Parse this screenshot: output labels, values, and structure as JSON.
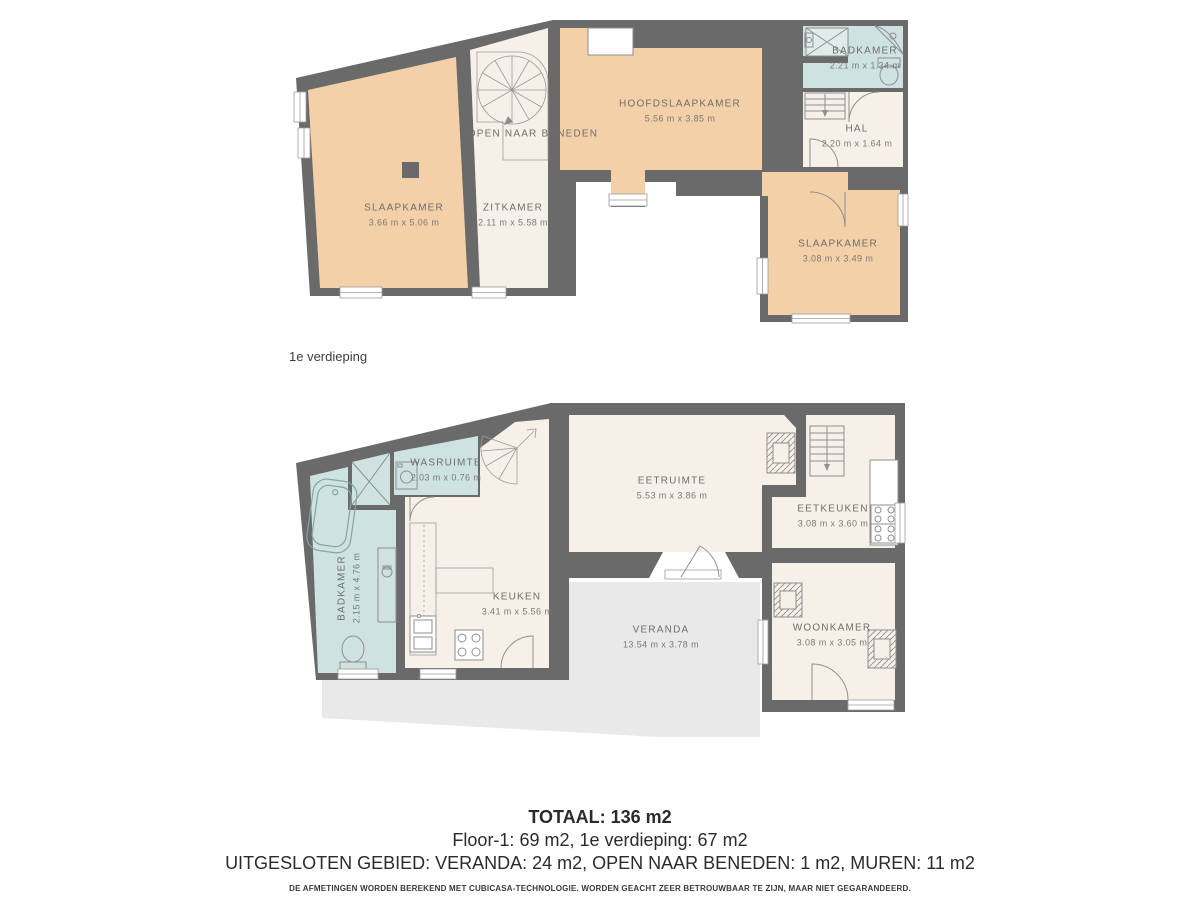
{
  "colors": {
    "wall": "#6a6a6a",
    "room_warm": "#f4d0a8",
    "room_cream": "#f7f0e9",
    "room_wet": "#cfe2e2",
    "veranda": "#e9e9e9",
    "background": "#ffffff"
  },
  "upper_floor": {
    "caption": "1e verdieping",
    "rooms": {
      "slaapkamer_left": {
        "name": "SLAAPKAMER",
        "dims": "3.66 m x 5.06 m"
      },
      "zitkamer": {
        "name": "ZITKAMER",
        "dims": "2.11 m x 5.58 m"
      },
      "open_naar_beneden": {
        "name": "OPEN NAAR BENEDEN"
      },
      "hoofdslaapkamer": {
        "name": "HOOFDSLAAPKAMER",
        "dims": "5.56 m x 3.85 m"
      },
      "badkamer": {
        "name": "BADKAMER",
        "dims": "2.21 m x 1.34 m"
      },
      "hal": {
        "name": "HAL",
        "dims": "2.20 m x 1.64 m"
      },
      "slaapkamer_right": {
        "name": "SLAAPKAMER",
        "dims": "3.08 m x 3.49 m"
      }
    }
  },
  "ground_floor": {
    "rooms": {
      "wasruimte": {
        "name": "WASRUIMTE",
        "dims": "2.03 m x 0.76 m"
      },
      "badkamer": {
        "name": "BADKAMER",
        "dims": "2.15 m x 4.76 m"
      },
      "keuken": {
        "name": "KEUKEN",
        "dims": "3.41 m x 5.56 m"
      },
      "eetruimte": {
        "name": "EETRUIMTE",
        "dims": "5.53 m x 3.86 m"
      },
      "eetkeuken": {
        "name": "EETKEUKEN",
        "dims": "3.08 m x 3.60 m"
      },
      "woonkamer": {
        "name": "WOONKAMER",
        "dims": "3.08 m x 3.05 m"
      },
      "veranda": {
        "name": "VERANDA",
        "dims": "13.54 m x 3.78 m"
      }
    }
  },
  "footer": {
    "total": "TOTAAL: 136 m2",
    "floors_line": "Floor-1: 69 m2, 1e verdieping: 67 m2",
    "excluded_line": "UITGESLOTEN GEBIED: VERANDA: 24 m2, OPEN NAAR BENEDEN: 1 m2, MUREN: 11 m2",
    "disclaimer": "DE AFMETINGEN WORDEN BEREKEND MET CUBICASA-TECHNOLOGIE. WORDEN GEACHT ZEER BETROUWBAAR TE ZIJN, MAAR NIET GEGARANDEERD."
  }
}
